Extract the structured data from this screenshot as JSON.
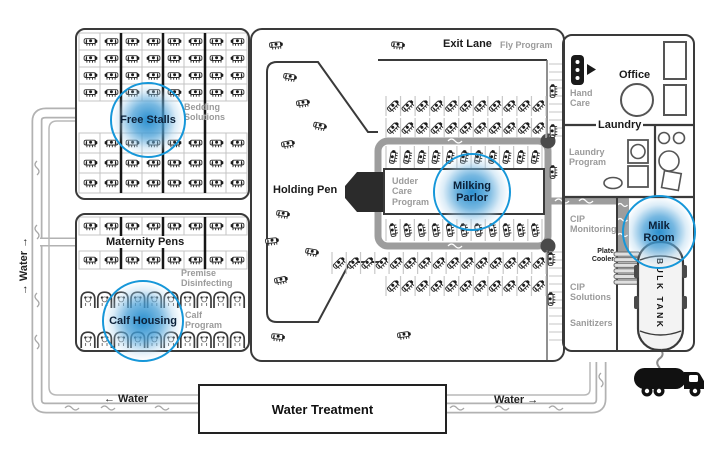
{
  "colors": {
    "accent_blue": "#1697d9",
    "outline": "#3a3a3a",
    "gray_text": "#9b9b9b",
    "pipe_gray": "#9d9d9d"
  },
  "areas": {
    "free_stalls": {
      "label": "Free Stalls",
      "program": "Bedding Solutions"
    },
    "maternity_pens": {
      "label": "Maternity Pens",
      "program": "Premise Disinfecting"
    },
    "calf_housing": {
      "label": "Calf Housing",
      "program": "Calf Program"
    },
    "holding_pen": {
      "label": "Holding Pen"
    },
    "exit_lane": {
      "label": "Exit Lane",
      "program": "Fly Program"
    },
    "milking_parlor": {
      "label": "Milking Parlor",
      "program": "Udder Care Program"
    },
    "office": {
      "label": "Office",
      "program": "Hand Care"
    },
    "laundry": {
      "label": "Laundry",
      "program": "Laundry Program"
    },
    "milk_room": {
      "label": "Milk Room",
      "programs": {
        "monitoring": "CIP Monitoring",
        "solutions": "CIP Solutions",
        "sanitizers": "Sanitizers"
      },
      "plate_cooler": "Plate Cooler",
      "bulk_tank": "BULK TANK"
    },
    "water_treatment": {
      "label": "Water Treatment"
    }
  },
  "water": {
    "vertical_label": "→ Water →",
    "bottom_left_label": "← Water",
    "bottom_right_label": "Water →"
  }
}
